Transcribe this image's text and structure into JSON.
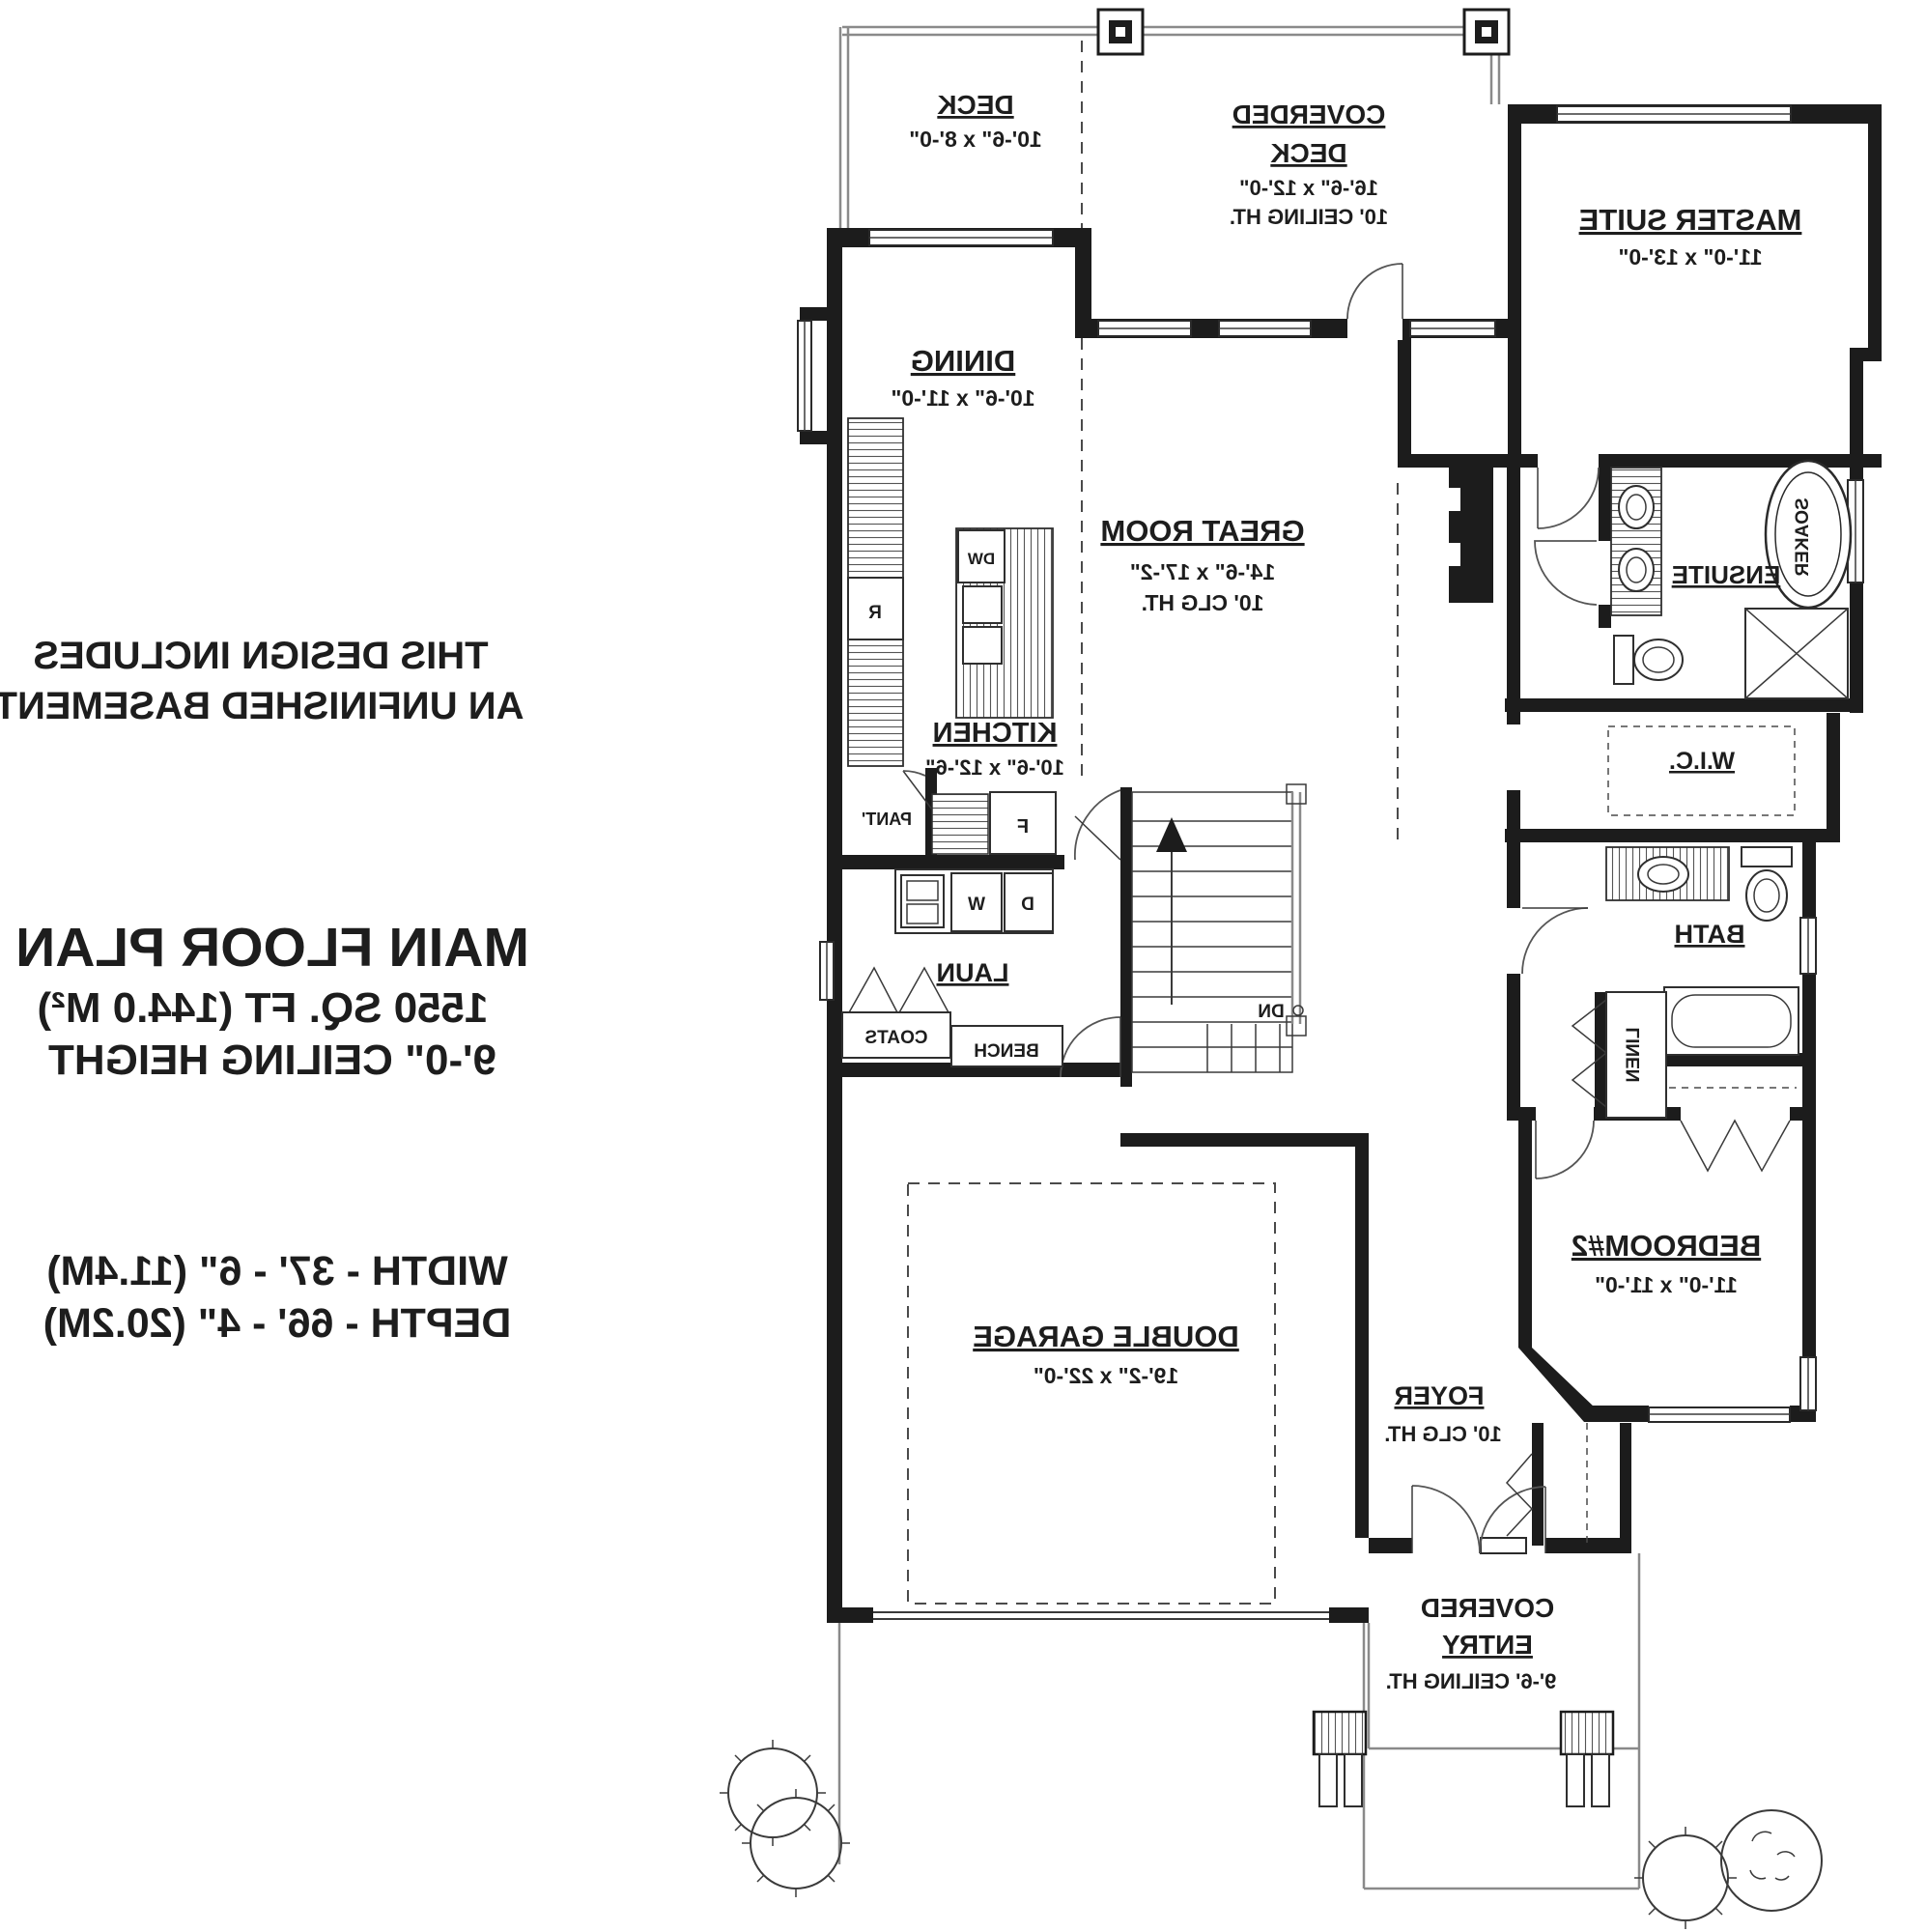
{
  "side_text": {
    "note_line1": "THIS DESIGN INCLUDES",
    "note_line2": "AN UNFINISHED BASEMENT",
    "title": "MAIN FLOOR PLAN",
    "area": "1550 SQ. FT (144.0 M²)",
    "ceiling": "9'-0\" CEILING HEIGHT",
    "width": "WIDTH - 37' - 6\" (11.4M)",
    "depth": "DEPTH - 66' - 4\" (20.2M)"
  },
  "rooms": {
    "deck": {
      "name": "DECK",
      "dims": "10'-6\" x 8'-0\""
    },
    "covered_deck": {
      "name_line1": "COVERDED",
      "name_line2": "DECK",
      "dims": "16'-6\" x 12'-0\"",
      "ceiling": "10' CEILING HT."
    },
    "master_suite": {
      "name": "MASTER SUITE",
      "dims": "11'-0\" x 13'-0\""
    },
    "dining": {
      "name": "DINING",
      "dims": "10'-6\" x 11'-0\""
    },
    "great_room": {
      "name": "GREAT ROOM",
      "dims": "14'-6\" x 17'-2\"",
      "ceiling": "10' CLG HT."
    },
    "kitchen": {
      "name": "KITCHEN",
      "dims": "10'-6\" x 12'-6\""
    },
    "ensuite": {
      "name": "ENSUITE"
    },
    "wic": {
      "name": "W.I.C."
    },
    "bath": {
      "name": "BATH"
    },
    "laundry": {
      "name": "LAUN"
    },
    "bedroom2": {
      "name": "BEDROOM#2",
      "dims": "11'-0\" x 11'-0\""
    },
    "garage": {
      "name": "DOUBLE GARAGE",
      "dims": "19'-2\" x 22'-0\""
    },
    "foyer": {
      "name": "FOYER",
      "ceiling": "10' CLG HT."
    },
    "covered_entry": {
      "name_line1": "COVERED",
      "name_line2": "ENTRY",
      "ceiling": "9'-6' CEILING HT."
    }
  },
  "fixtures": {
    "soaker_tub": "SOAKER",
    "linen": "LINEN",
    "coats": "COATS",
    "bench": "BENCH",
    "pantry": "PANT'",
    "washer": "W",
    "dryer": "D",
    "dishwasher": "DW",
    "fridge": "R",
    "freezer": "F",
    "stairs_down": "DN"
  },
  "colors": {
    "wall": "#1c1c1c",
    "line": "#3a3a3a",
    "background": "#ffffff"
  }
}
